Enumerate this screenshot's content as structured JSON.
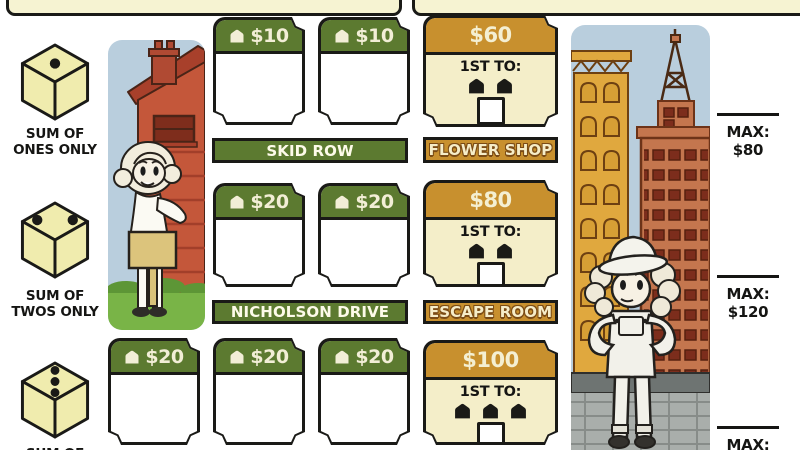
{
  "colors": {
    "green": "#5c7a30",
    "orange": "#c8902e",
    "cream_text": "#f2eed6",
    "bonus_body": "#f4eec9",
    "tab_yellow": "#f6f3d2",
    "die_yellow": "#f0ecae",
    "ink": "#1a1a17",
    "sky": "#b9cedd",
    "house_red": "#c4573a",
    "grass_green": "#79b447",
    "yellow_building": "#e0a83e",
    "red_building": "#c4764e",
    "wall_gray": "#a9aeab"
  },
  "dice": [
    {
      "pips": 1,
      "label1": "SUM OF",
      "label2": "ONES ONLY"
    },
    {
      "pips": 2,
      "label1": "SUM OF",
      "label2": "TWOS ONLY"
    },
    {
      "pips": 3,
      "label1": "SUM OF",
      "label2": ""
    }
  ],
  "streets": {
    "row1": {
      "name": "SKID ROW",
      "cards": [
        {
          "price": "$10"
        },
        {
          "price": "$10"
        }
      ]
    },
    "row2": {
      "name": "NICHOLSON DRIVE",
      "cards": [
        {
          "price": "$20"
        },
        {
          "price": "$20"
        }
      ]
    },
    "row3": {
      "name": "",
      "cards": [
        {
          "price": "$20"
        },
        {
          "price": "$20"
        },
        {
          "price": "$20"
        }
      ]
    }
  },
  "bonuses": {
    "row1": {
      "price": "$60",
      "first_to_label": "1ST TO:",
      "houses_required": 2,
      "banner": "FLOWER SHOP"
    },
    "row2": {
      "price": "$80",
      "first_to_label": "1ST TO:",
      "houses_required": 2,
      "banner": "ESCAPE ROOM"
    },
    "row3": {
      "price": "$100",
      "first_to_label": "1ST TO:",
      "houses_required": 3,
      "banner": ""
    }
  },
  "limits": [
    {
      "label": "MAX:",
      "value": "$80"
    },
    {
      "label": "MAX:",
      "value": "$120"
    },
    {
      "label": "MAX:",
      "value": ""
    }
  ]
}
